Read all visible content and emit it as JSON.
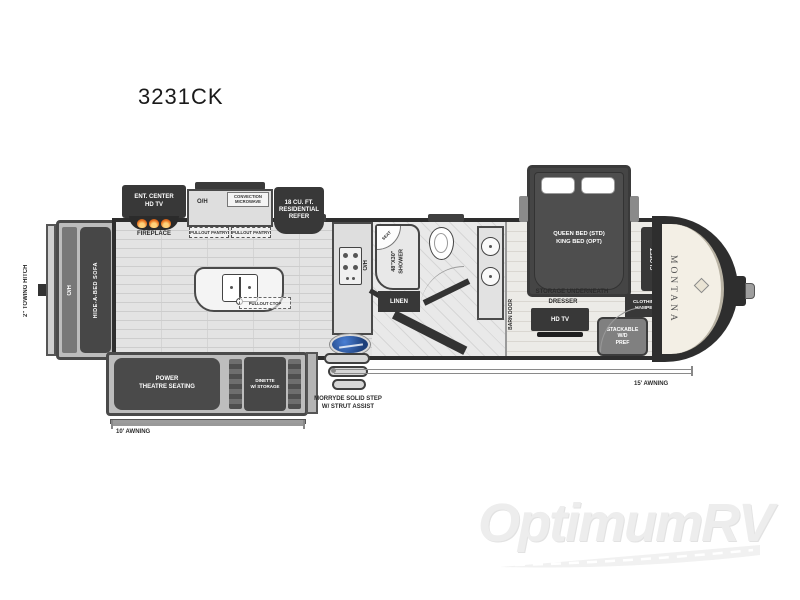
{
  "title": "3231CK",
  "colors": {
    "plan_dark": "#383838",
    "floor_gray": "#e3e3e3",
    "flame_orange": "#e8731f",
    "badge_blue": "#2a59a8",
    "cap_cream": "#f3efe5",
    "watermark_gray": "#ededed"
  },
  "exterior": {
    "towing_hitch": "2\" TOWING HITCH",
    "awning_left": "10' AWNING",
    "awning_right": "15' AWNING",
    "step": "MORRYDE SOLID STEP\nW/ STRUT ASSIST",
    "brand_cap": "MONTANA"
  },
  "rear_slide": {
    "overhead": "O/H",
    "sofa": "HIDE-A-BED SOFA"
  },
  "living": {
    "ent_center": "ENT. CENTER\nHD TV",
    "fireplace": "FIREPLACE",
    "theatre": "POWER\nTHEATRE SEATING",
    "dinette": "DINETTE\nW/ STORAGE"
  },
  "kitchen": {
    "overhead": "O/H",
    "microwave": "CONVECTION\nMICROWAVE",
    "refrigerator": "18 CU. FT.\nRESIDENTIAL\nREFER",
    "pantry_left": "PULLOUT PANTRY",
    "pantry_right": "PULLOUT PANTRY",
    "pullout_ctop": "PULLOUT CTOP",
    "counter_overhead": "O/H"
  },
  "bath": {
    "shower": "48\"X30\"\nSHOWER",
    "seat": "SEAT",
    "linen": "LINEN",
    "barn_door": "BARN DOOR"
  },
  "bedroom": {
    "bed": "QUEEN BED (STD)\nKING BED (OPT)",
    "storage": "STORAGE UNDERNEATH",
    "closet": "CLOSET",
    "hamper": "CLOTHING\nHAMPER",
    "wd_prep": "STACKABLE\nW/D\nPREF",
    "dresser": "DRESSER",
    "tv": "HD TV"
  },
  "watermark": "OptimumRV"
}
